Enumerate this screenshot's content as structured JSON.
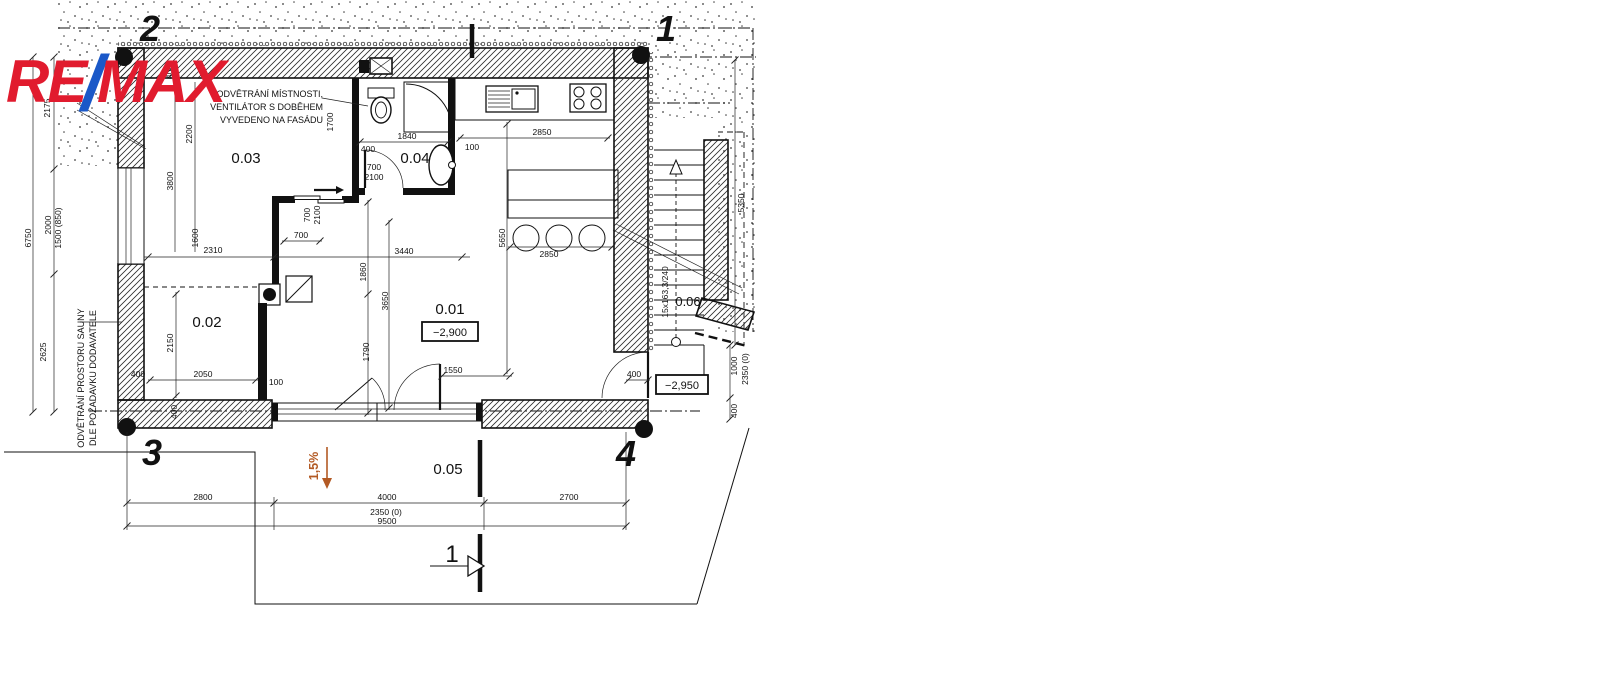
{
  "logo": {
    "re": "RE",
    "slash": "/",
    "max": "MAX"
  },
  "colors": {
    "remax_red": "#e11b2e",
    "remax_blue": "#1a58c8",
    "slope_orange": "#b35a24",
    "line_black": "#111111"
  },
  "grid": {
    "top_left": "2",
    "top_right": "1",
    "bottom_left": "3",
    "bottom_right": "4"
  },
  "rooms": {
    "r01": "0.01",
    "r02": "0.02",
    "r03": "0.03",
    "r04": "0.04",
    "r05": "0.05",
    "r06": "0.06"
  },
  "elevations": {
    "room01": "−2,900",
    "exterior": "−2,950"
  },
  "annotations": {
    "vent1": "ODVĚTRÁNÍ MÍSTNOSTI,",
    "vent2": "VENTILÁTOR S DOBĚHEM",
    "vent3": "VYVEDENO NA FASÁDU",
    "sauna1": "ODVĚTRÁNÍ PROSTORU SAUNY",
    "sauna2": "DLE POŽADAVKU DODAVATELE",
    "slope": "1,5%",
    "stair_spec": "15x163,3/240",
    "section": "1"
  },
  "dims": {
    "d2175": "2175",
    "d6750": "6750",
    "d2000": "2000",
    "d1500": "1500 (850)",
    "d2625": "2625",
    "d400top": "400",
    "d2200": "2200",
    "d3800": "3800",
    "d1600": "1600",
    "d2310": "2310",
    "door03_700": "700",
    "door03_2100": "2100",
    "door03_w": "700",
    "d1700": "1700",
    "d1840": "1840",
    "door04_700": "700",
    "door04_2100": "2100",
    "d400a": "400",
    "d2850k": "2850",
    "d100k": "100",
    "d3440": "3440",
    "d1860": "1860",
    "d3650": "3650",
    "d1790": "1790",
    "d5650": "5650",
    "d2850b": "2850",
    "d1550": "1550",
    "d2150": "2150",
    "d2050": "2050",
    "d400b": "400",
    "d100b": "100",
    "d400w": "400",
    "c2800": "2800",
    "c4000": "4000",
    "c2350": "2350 (0)",
    "c9500": "9500",
    "c2700": "2700",
    "r5350": "5350",
    "r1000": "1000",
    "r2350": "2350 (0)",
    "r400": "400",
    "r400d": "400"
  }
}
